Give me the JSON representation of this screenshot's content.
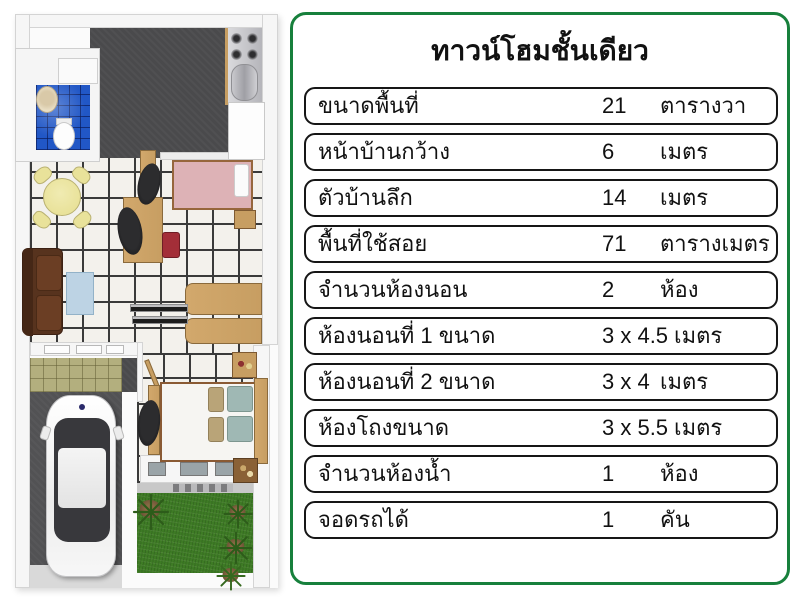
{
  "panel": {
    "title": "ทาวน์โฮมชั้นเดียว",
    "rows": [
      {
        "label": "ขนาดพื้นที่",
        "value": "21",
        "unit": "ตารางวา"
      },
      {
        "label": "หน้าบ้านกว้าง",
        "value": "6",
        "unit": "เมตร"
      },
      {
        "label": "ตัวบ้านลึก",
        "value": "14",
        "unit": "เมตร"
      },
      {
        "label": "พื้นที่ใช้สอย",
        "value": "71",
        "unit": "ตารางเมตร"
      },
      {
        "label": "จำนวนห้องนอน",
        "value": "2",
        "unit": "ห้อง"
      },
      {
        "label": "ห้องนอนที่ 1 ขนาด",
        "value": "3 x 4.5",
        "unit": "เมตร"
      },
      {
        "label": "ห้องนอนที่ 2 ขนาด",
        "value": "3 x 4",
        "unit": "เมตร"
      },
      {
        "label": "ห้องโถงขนาด",
        "value": "3 x 5.5",
        "unit": "เมตร"
      },
      {
        "label": "จำนวนห้องน้ำ",
        "value": "1",
        "unit": "ห้อง"
      },
      {
        "label": "จอดรถได้",
        "value": "1",
        "unit": "คัน"
      }
    ]
  },
  "colors": {
    "accent": "#17803c",
    "tile_white": "#f3f1ec",
    "tile_grout": "#3a3a3a",
    "tile_blue": "#2157c6",
    "floor_dark": "#4a4a4c",
    "floor_olive": "#b3af7e",
    "grass": "#3e7b25",
    "wood": "#c79e62",
    "sofa_brown": "#57331e",
    "bed_pink": "#ddb2b6",
    "table_yellow": "#e9e29a",
    "chair_red": "#a32e38",
    "coffee_blue": "#bdd3e4",
    "car_glass": "#38383c"
  }
}
